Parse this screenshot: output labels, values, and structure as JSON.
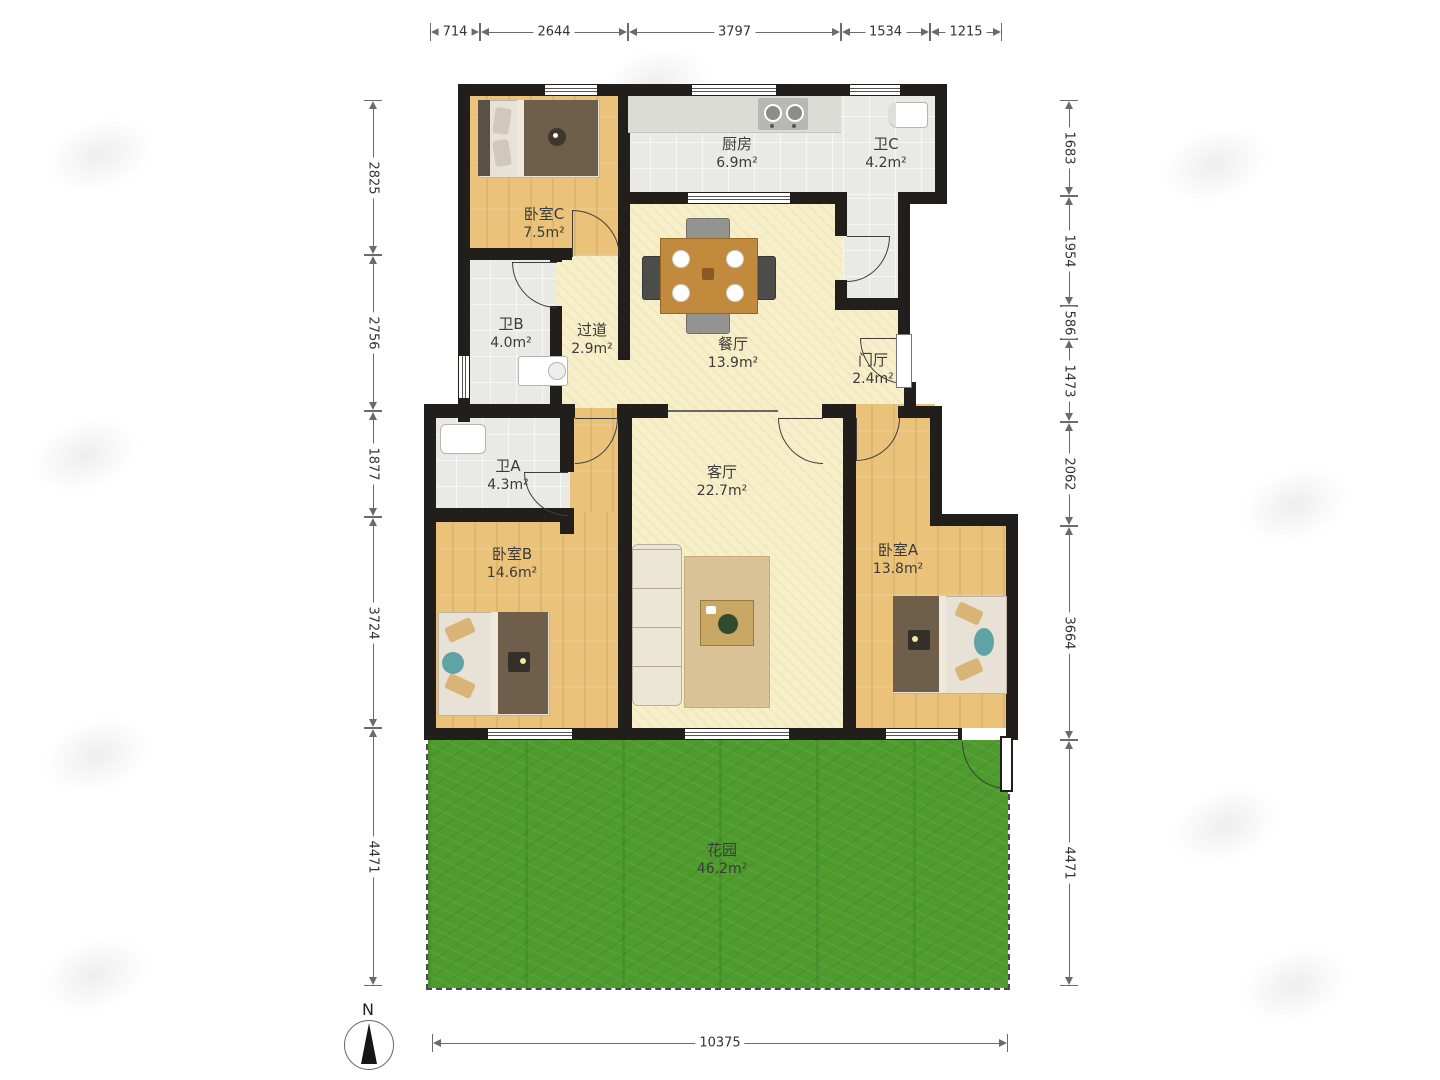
{
  "title": "三室两厅户型图",
  "rooms": [
    {
      "id": "bedroom-c",
      "name": "卧室C",
      "area": "7.5m²"
    },
    {
      "id": "kitchen",
      "name": "厨房",
      "area": "6.9m²"
    },
    {
      "id": "bath-c",
      "name": "卫C",
      "area": "4.2m²"
    },
    {
      "id": "bath-b",
      "name": "卫B",
      "area": "4.0m²"
    },
    {
      "id": "hallway",
      "name": "过道",
      "area": "2.9m²"
    },
    {
      "id": "dining",
      "name": "餐厅",
      "area": "13.9m²"
    },
    {
      "id": "foyer",
      "name": "门厅",
      "area": "2.4m²"
    },
    {
      "id": "bath-a",
      "name": "卫A",
      "area": "4.3m²"
    },
    {
      "id": "living",
      "name": "客厅",
      "area": "22.7m²"
    },
    {
      "id": "bedroom-b",
      "name": "卧室B",
      "area": "14.6m²"
    },
    {
      "id": "bedroom-a",
      "name": "卧室A",
      "area": "13.8m²"
    },
    {
      "id": "garden",
      "name": "花园",
      "area": "46.2m²"
    }
  ],
  "dimensions": {
    "top": [
      "714",
      "2644",
      "3797",
      "1534",
      "1215"
    ],
    "left": [
      "2825",
      "2756",
      "1877",
      "3724",
      "4471"
    ],
    "right": [
      "1683",
      "1954",
      "586",
      "1473",
      "2062",
      "3664",
      "4471"
    ],
    "bottom": [
      "10375"
    ]
  },
  "compass": {
    "label": "N"
  },
  "colors": {
    "wall": "#211e1c",
    "wood_floor": "#eac27a",
    "hall_floor": "#f7efc9",
    "tile_floor": "#e9e9e5",
    "garden_grass": "#4f9c2e",
    "dimension_line": "#6b6b6b",
    "label_text": "#3b3b3b"
  }
}
